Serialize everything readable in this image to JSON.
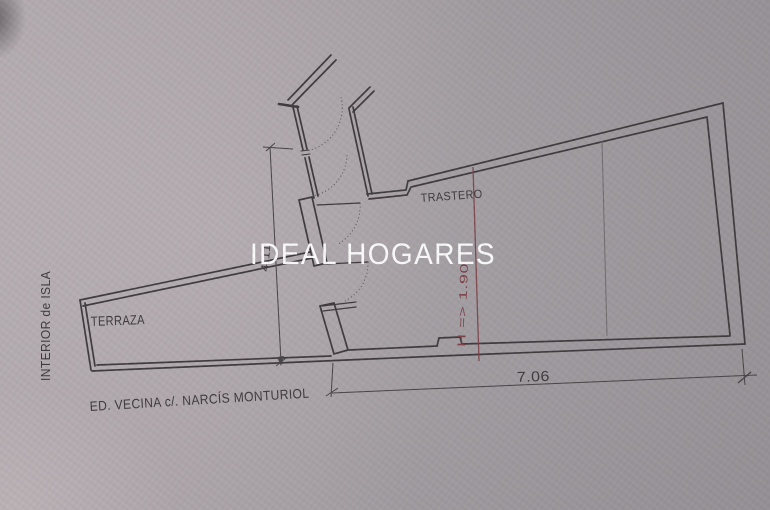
{
  "photo": {
    "watermark": "IDEAL HOGARES"
  },
  "plan": {
    "rooms": [
      {
        "name": "TRASTERO"
      },
      {
        "name": "TERRAZA"
      }
    ],
    "margin_label": "INTERIOR de ISLA",
    "street_caption": "ED. VECINA c/. NARCÍS MONTURIOL",
    "dimensions": {
      "bottom_width": "7.06",
      "left_height": "4.11",
      "height_note": "H => 1.90"
    },
    "colors": {
      "ink": "#3e3a3d",
      "annotation_red": "#7b4046",
      "paper": "#a9a2a7",
      "watermark": "#ffffff"
    }
  }
}
